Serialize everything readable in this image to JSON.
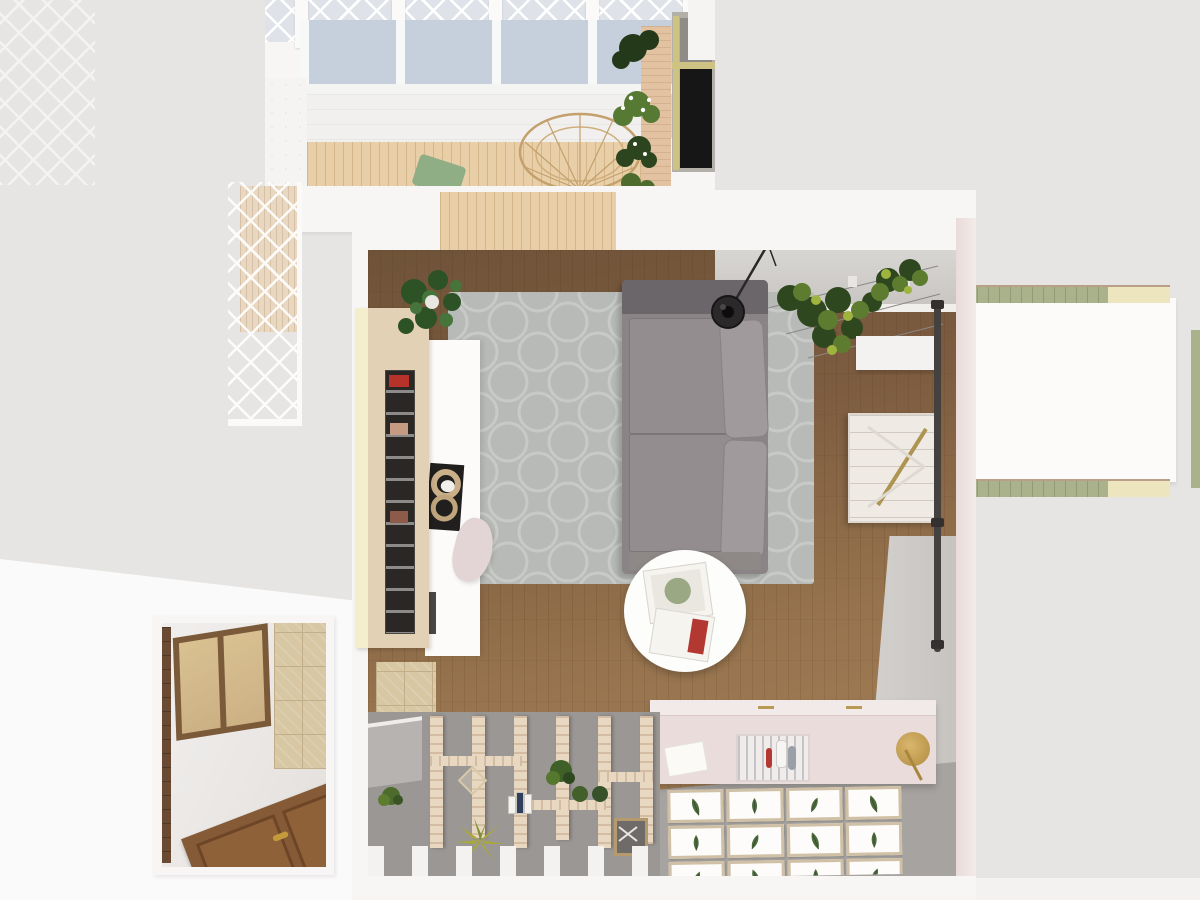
{
  "meta": {
    "kind": "3d-floorplan-top-view-render",
    "rooms": [
      "balcony",
      "living-room",
      "terrace",
      "hallway"
    ]
  },
  "colors": {
    "background": "#e6e5e3",
    "background_bottom": "#f3f2f0",
    "plane_white": "#fbfafa",
    "wall_white": "#f8f6f4",
    "wall_pink": "#e9dbda",
    "net_gray": "#dfe3e9",
    "glass_blue": "#c6d0dd",
    "canopy": "#f1f0ee",
    "balcony_wood": "#e9cfa7",
    "ledge_wood": "#e2c2a0",
    "cushion_green": "#8fae85",
    "frame_yellow": "#cfc383",
    "rug_gray": "#b7bab6",
    "rug_pattern": "#c7cac6",
    "floor_wood_dark": "#6f5338",
    "floor_wood_light": "#a8825a",
    "floor_back_gray": "#a7a3a0",
    "wardrobe_wood": "#e3d1b5",
    "cream_wall": "#f5eecd",
    "sofa_gray": "#8a8487",
    "sofa_dark": "#6b6669",
    "sofa_cushion": "#a09a9d",
    "pendant_black": "#2b292a",
    "ivy_dark": "#2f471f",
    "ivy_mid": "#5d7c30",
    "ivy_light": "#9fb43f",
    "barn_door": "#efebe4",
    "rail_dark": "#45413f",
    "brass": "#ad9450",
    "table_white": "#fdfdfc",
    "sideboard_pink": "#e9dcdb",
    "sideboard_top": "#f2eae9",
    "print_frame": "#cfc0a6",
    "print_green": "#4e6b3e",
    "terrace_floor": "#9a9795",
    "slat_wood": "#e8d7c1",
    "post_white": "#f4f2f0",
    "stone_beige": "#d7c7a3",
    "stone_grout": "#c2af8a",
    "door_brown": "#855a36",
    "door_panel": "#6d4527",
    "handle_brass": "#c49a3c",
    "amber_glass": "#d9c192",
    "window_frame_brown": "#7b5a3a",
    "hall_floor_dark": "#6b4a33",
    "bench_green": "#a9b28b",
    "bench_cream": "#ece5bd",
    "pouf_pink": "#e3d5d6",
    "mint_tray": "#eef4ee",
    "console_dark": "#4a4846",
    "agave_green": "#a8a83c",
    "lantern_tan": "#d9c8a8"
  },
  "living_room": {
    "gallery": {
      "print_count": 12
    }
  },
  "terrace": {
    "slat_count": 6
  },
  "balcony": {
    "roof_post_count": 5
  }
}
